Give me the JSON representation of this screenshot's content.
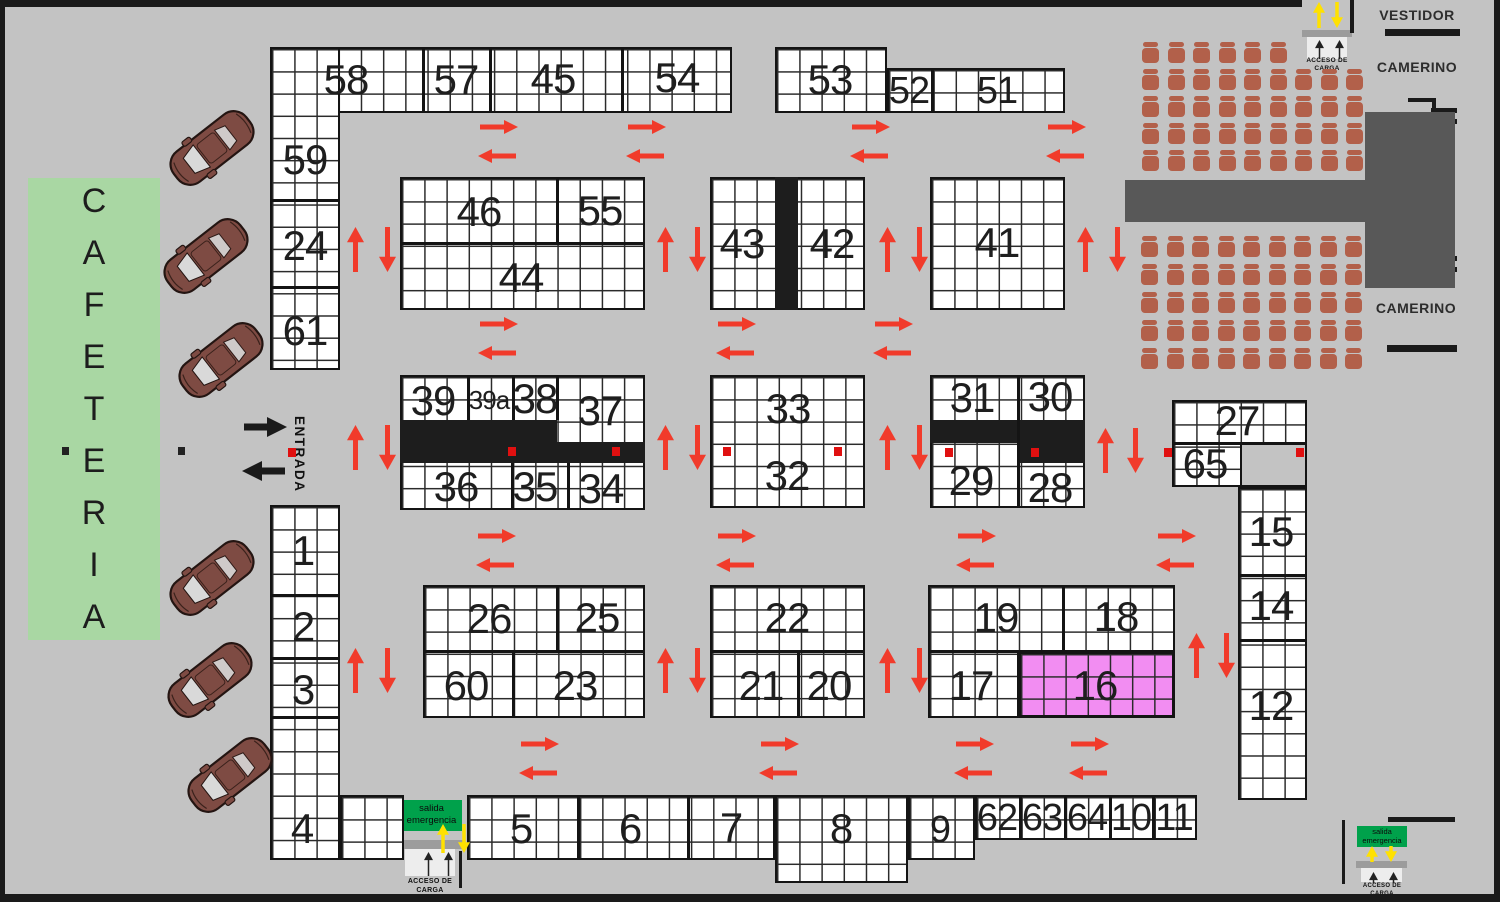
{
  "colors": {
    "bg": "#c3c3c3",
    "booth_white": "#ffffff",
    "grid_line": "#2b2b2b",
    "block_border": "#141414",
    "black_fill": "#1d1d1d",
    "pink": "#f28df2",
    "cafeteria_green": "#a9d7a3",
    "exit_green": "#00a14b",
    "chair": "#b2604a",
    "stage": "#585858",
    "red_arrow": "#f13b2b",
    "yellow_arrow": "#ffe100",
    "entrance_black": "#1a1a1a",
    "pillar_red": "#e01010",
    "pillar_dark": "#222222",
    "car_body": "#7e4b43",
    "car_glass": "#d9d9d9",
    "gray_bar": "#9c9c9c",
    "ramp_white": "#ededed",
    "wall": "#1a1a1a"
  },
  "areas": {
    "cafeteria": "CAFETERIA",
    "entrada": "ENTRADA",
    "vestidor": "VESTIDOR",
    "camerino_top": "CAMERINO",
    "camerino_bottom": "CAMERINO"
  },
  "signs": {
    "acceso": {
      "line1": "ACCESO DE",
      "line2": "CARGA"
    },
    "salida": {
      "line1": "salida",
      "line2": "emergencia"
    }
  },
  "booth_labels": {
    "58": "58",
    "57": "57",
    "45": "45",
    "54": "54",
    "53": "53",
    "52": "52",
    "51": "51",
    "59": "59",
    "24": "24",
    "61": "61",
    "46": "46",
    "55": "55",
    "44": "44",
    "43": "43",
    "42": "42",
    "41": "41",
    "39": "39",
    "39a": "39a",
    "38": "38",
    "37": "37",
    "36": "36",
    "35": "35",
    "34": "34",
    "33": "33",
    "32": "32",
    "31": "31",
    "30": "30",
    "29": "29",
    "28": "28",
    "27": "27",
    "65": "65",
    "15": "15",
    "14": "14",
    "12": "12",
    "1": "1",
    "2": "2",
    "3": "3",
    "4": "4",
    "26": "26",
    "25": "25",
    "60": "60",
    "23": "23",
    "22": "22",
    "21": "21",
    "20": "20",
    "19": "19",
    "18": "18",
    "17": "17",
    "16": "16",
    "5": "5",
    "6": "6",
    "7": "7",
    "8": "8",
    "9": "9",
    "62": "62",
    "63": "63",
    "64": "64",
    "10": "10",
    "11": "11"
  }
}
